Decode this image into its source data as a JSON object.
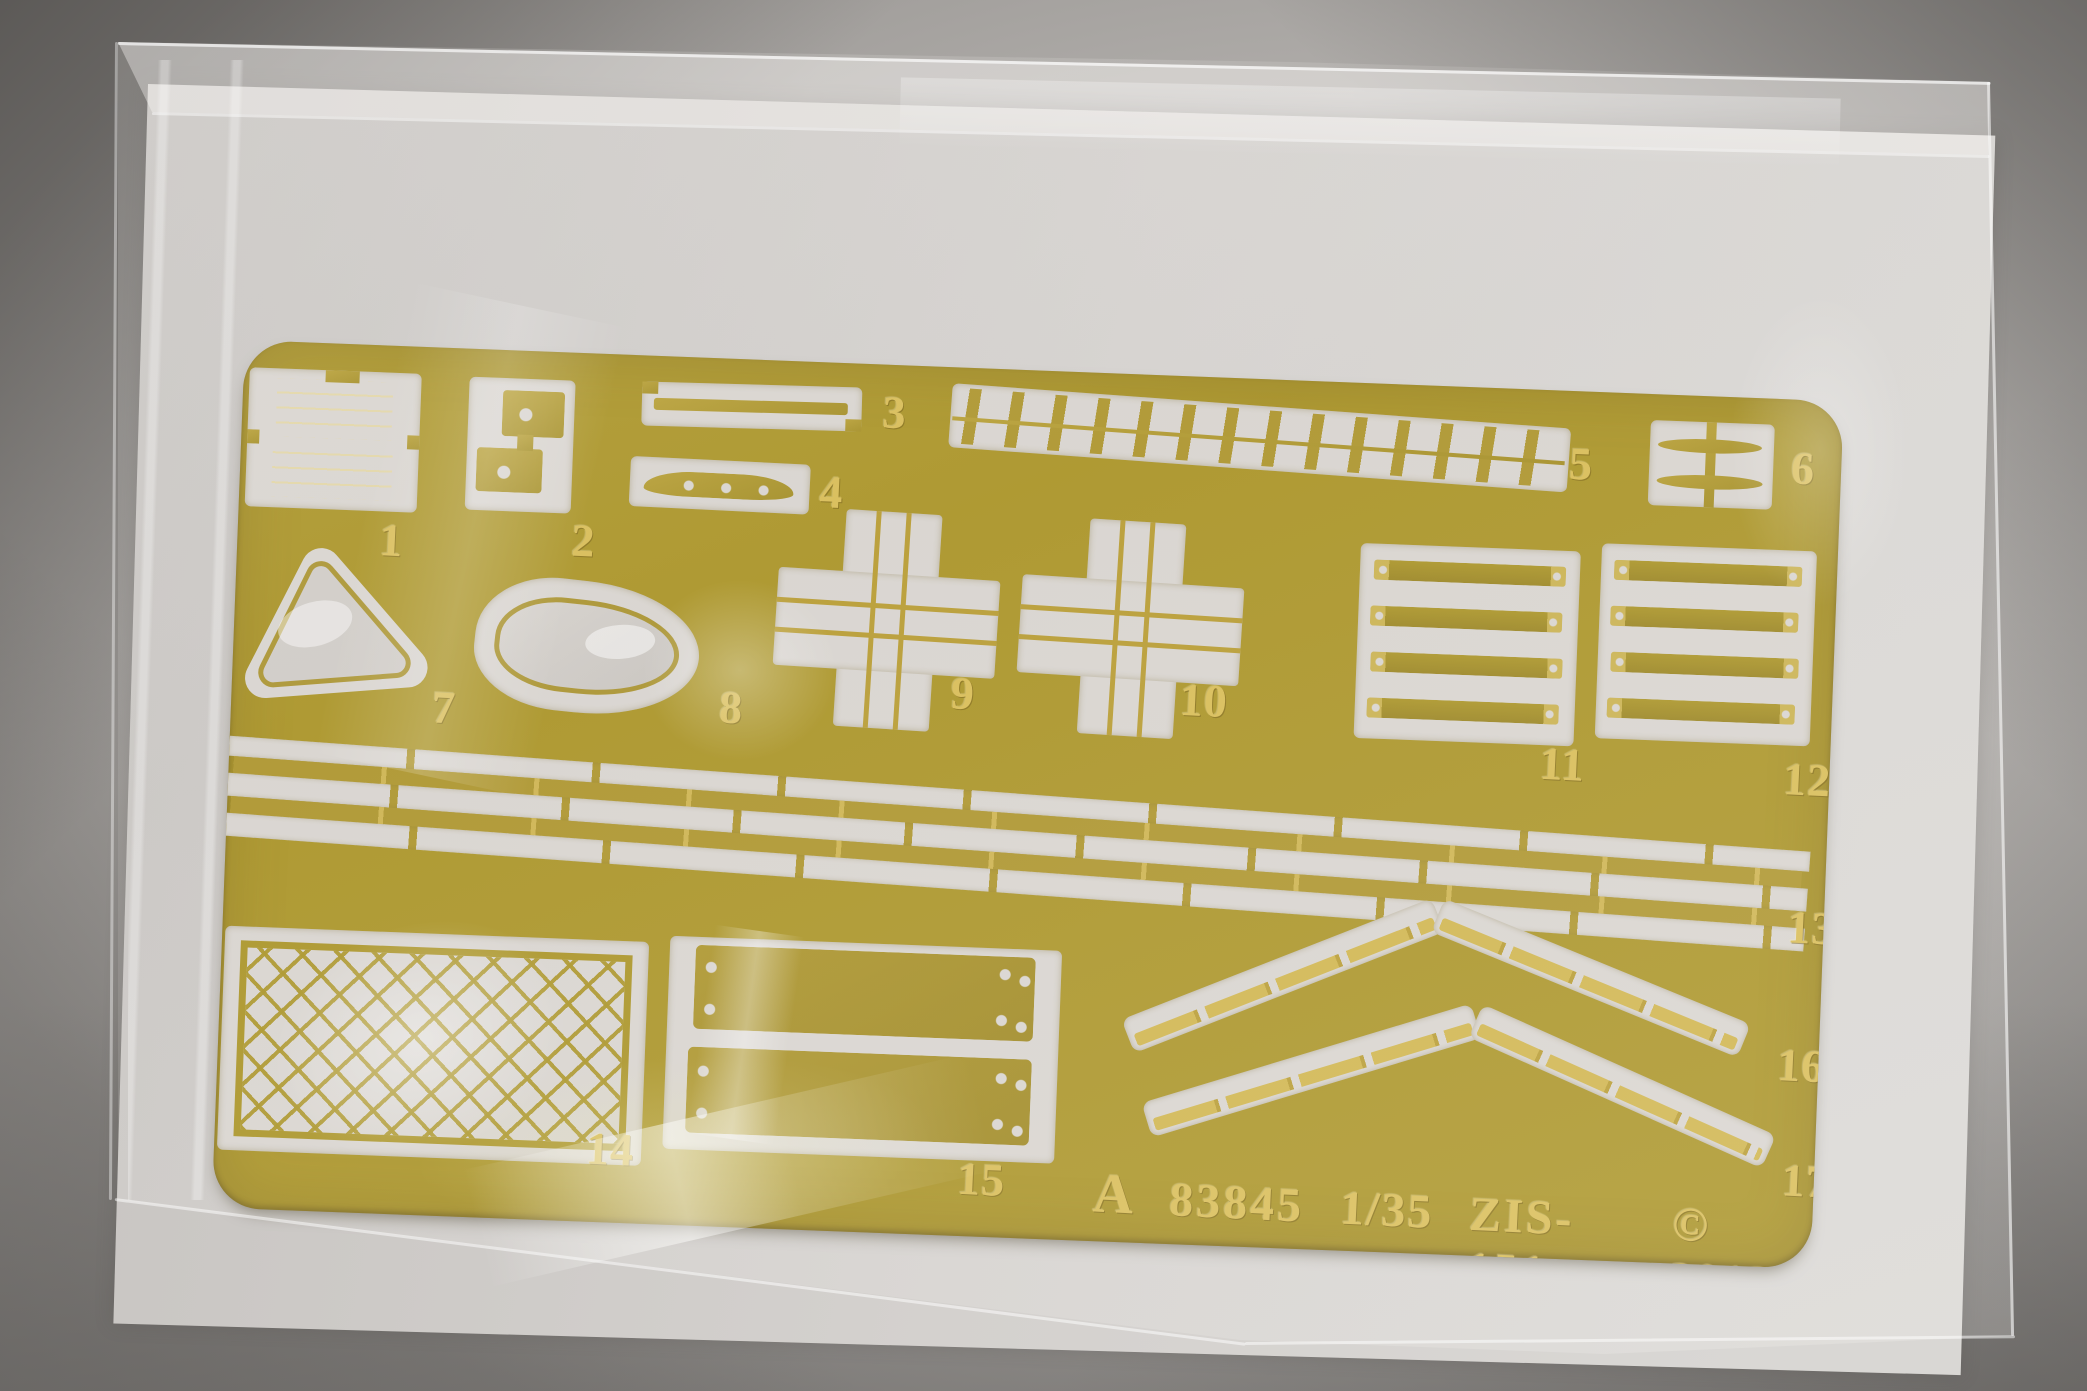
{
  "photo": {
    "subject": "photo-etched brass detail fret sealed in a clear plastic bag on a grey backdrop",
    "object_type": "model kit photo-etch sheet"
  },
  "fret": {
    "part_labels": [
      "1",
      "2",
      "3",
      "4",
      "5",
      "6",
      "7",
      "8",
      "9",
      "10",
      "11",
      "12",
      "13",
      "14",
      "15",
      "16",
      "17"
    ],
    "markings": {
      "sheet_letter": "A",
      "item_number": "83845",
      "scale": "1/35",
      "model": "ZIS-151",
      "copyright": "© 2013"
    }
  },
  "colors": {
    "brass": "#a8911f",
    "brass_light": "#c9b04a",
    "etched_text": "#d8bb50",
    "cutout": "#d8d4cf",
    "part_sheen": "#d0ccc7",
    "backdrop_grey": "#b3b0ad",
    "paper": "#d2cfcc"
  }
}
